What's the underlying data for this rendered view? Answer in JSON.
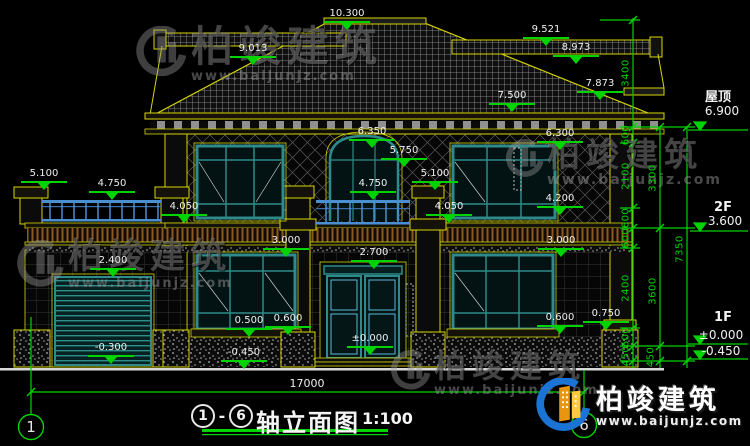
{
  "drawing_title": {
    "axis_start": "1",
    "axis_end": "6",
    "dash": "-",
    "name": "轴立面图",
    "scale": "1:100"
  },
  "brand": {
    "name": "柏竣建筑",
    "url": "www.baijunjz.com"
  },
  "total_width_dim": "17000",
  "axis_bubbles": {
    "left": "1",
    "right": "6"
  },
  "floor_levels": {
    "roof_label": "屋顶",
    "roof_level": "6.900",
    "f2_label": "2F",
    "f2_level": "3.600",
    "f1_label": "1F",
    "f1_level_zero": "±0.000",
    "f1_level_ground": "-0.450"
  },
  "elevation_marks": [
    {
      "v": "10.300"
    },
    {
      "v": "9.521"
    },
    {
      "v": "9.013"
    },
    {
      "v": "8.973"
    },
    {
      "v": "7.873"
    },
    {
      "v": "7.500"
    },
    {
      "v": "6.350"
    },
    {
      "v": "6.300"
    },
    {
      "v": "5.750"
    },
    {
      "v": "5.100"
    },
    {
      "v": "5.100"
    },
    {
      "v": "4.750"
    },
    {
      "v": "4.750"
    },
    {
      "v": "4.200"
    },
    {
      "v": "4.050"
    },
    {
      "v": "4.050"
    },
    {
      "v": "3.000"
    },
    {
      "v": "3.000"
    },
    {
      "v": "2.700"
    },
    {
      "v": "2.400"
    },
    {
      "v": "0.500"
    },
    {
      "v": "0.600"
    },
    {
      "v": "0.600"
    },
    {
      "v": "0.750"
    },
    {
      "v": "-0.300"
    },
    {
      "v": "-0.450"
    },
    {
      "v": "±0.000"
    }
  ],
  "chain_dims": [
    {
      "v": "3400"
    },
    {
      "v": "600"
    },
    {
      "v": "2100"
    },
    {
      "v": "600"
    },
    {
      "v": "600"
    },
    {
      "v": "2400"
    },
    {
      "v": "600"
    },
    {
      "v": "450"
    },
    {
      "v": "3300"
    },
    {
      "v": "3600"
    },
    {
      "v": "450"
    },
    {
      "v": "7350"
    }
  ],
  "colors": {
    "cad_yellow": "#d6d600",
    "dim_green": "#00d400",
    "window_teal": "#2e8b8b",
    "railing_blue": "#4a8fd0"
  }
}
